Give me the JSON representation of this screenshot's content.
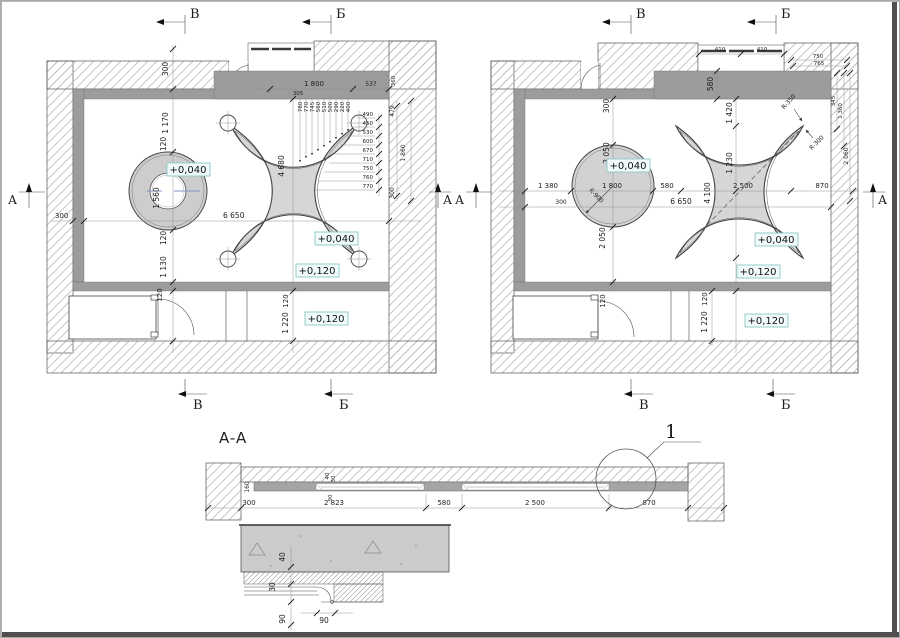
{
  "markers": {
    "b": "В",
    "g": "Б",
    "a": "А"
  },
  "levels": {
    "v40": "+0,040",
    "v120": "+0,120"
  },
  "left_plan": {
    "dims": {
      "niche_300": "300",
      "v_1170": "1 170",
      "v_120a": "120",
      "circle_1560": "1 560",
      "v_120b": "120",
      "v_1130": "1 130",
      "v_120c": "120",
      "v_120d": "120",
      "v_1220": "1 220",
      "left_300": "300",
      "width_6650": "6 650",
      "star_4680": "4 680",
      "top_1800": "1 800",
      "top_537": "537",
      "top_305": "305",
      "top_360": "360",
      "top_small": [
        "780",
        "770",
        "745",
        "560",
        "510",
        "500",
        "290",
        "220",
        "400"
      ],
      "right_small": [
        "490",
        "450",
        "530",
        "600",
        "670",
        "710",
        "750",
        "760",
        "770"
      ],
      "right_479": "479",
      "right_1860": "1 860",
      "right_300": "300"
    }
  },
  "right_plan": {
    "dims": {
      "h_1380": "1 380",
      "h_1800": "1 800",
      "h_580": "580",
      "h_2500": "2 500",
      "h_870": "870",
      "left_300": "300",
      "width_6650": "6 650",
      "v_580": "580",
      "v_1420": "1 420",
      "v_300": "300",
      "v_2050a": "2 050",
      "v_2050b": "2 050",
      "v_1230": "1 230",
      "v_4100": "4 100",
      "v_120a": "120",
      "v_120b": "120",
      "v_1220": "1 220",
      "r350": "R-350",
      "r300": "R-300",
      "r900": "R-900",
      "top_750": "750",
      "top_765": "765",
      "right_345": "345",
      "right_1360": "1 360",
      "right_2060": "2 060",
      "niche_410a": "410",
      "niche_410b": "410"
    }
  },
  "section": {
    "title": "A-A",
    "callout": "1",
    "dims": {
      "d300": "300",
      "d2823": "2 823",
      "d580": "580",
      "d2500": "2 500",
      "d870": "870",
      "v160": "160",
      "v40": "40",
      "v30": "30",
      "v90": "90"
    }
  },
  "detail": {
    "dims": {
      "d40": "40",
      "d30": "30",
      "d90v": "90",
      "d90h": "90"
    }
  }
}
